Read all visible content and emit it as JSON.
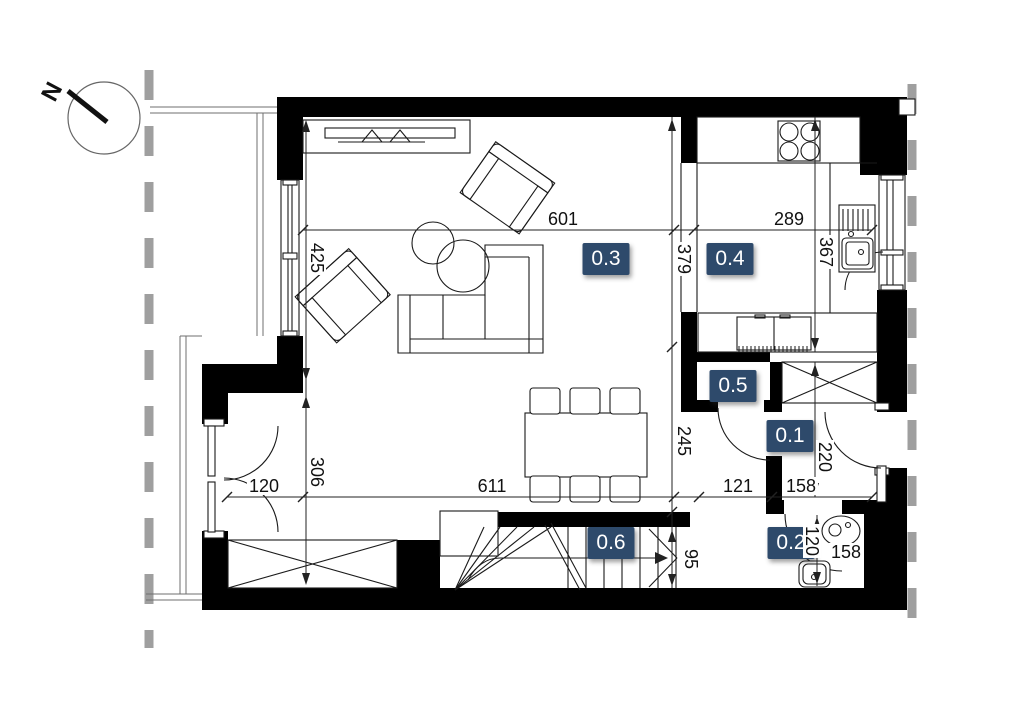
{
  "compass": {
    "label": "N"
  },
  "rooms": [
    {
      "label": "0.3"
    },
    {
      "label": "0.4"
    },
    {
      "label": "0.5"
    },
    {
      "label": "0.1"
    },
    {
      "label": "0.6"
    },
    {
      "label": "0.2"
    }
  ],
  "dimensions": [
    {
      "value": "601",
      "orientation": "horizontal"
    },
    {
      "value": "289",
      "orientation": "horizontal"
    },
    {
      "value": "425",
      "orientation": "vertical"
    },
    {
      "value": "379",
      "orientation": "vertical"
    },
    {
      "value": "367",
      "orientation": "vertical"
    },
    {
      "value": "245",
      "orientation": "vertical"
    },
    {
      "value": "306",
      "orientation": "vertical"
    },
    {
      "value": "220",
      "orientation": "vertical"
    },
    {
      "value": "120",
      "orientation": "horizontal"
    },
    {
      "value": "611",
      "orientation": "horizontal"
    },
    {
      "value": "121",
      "orientation": "horizontal"
    },
    {
      "value": "158",
      "orientation": "horizontal"
    },
    {
      "value": "95",
      "orientation": "vertical"
    },
    {
      "value": "120",
      "orientation": "vertical"
    },
    {
      "value": "158",
      "orientation": "horizontal"
    }
  ],
  "colors": {
    "room_badge": "#2e4a6b",
    "wall": "#000000",
    "line": "#1a1a1a",
    "boundary_dash": "#9f9f9f",
    "background": "#ffffff"
  }
}
